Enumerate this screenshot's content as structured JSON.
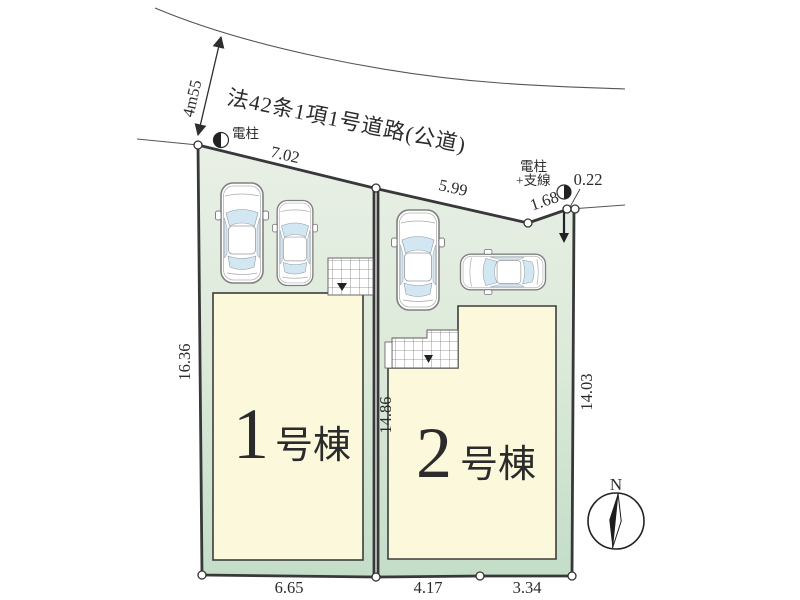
{
  "road": {
    "name": "法42条1項1号道路(公道)",
    "width_label": "4m55"
  },
  "poles": {
    "pole1_label": "電柱",
    "pole2_label_line1": "電柱",
    "pole2_label_line2": "+支線"
  },
  "dimensions": {
    "frontage_1": "7.02",
    "frontage_2": "5.99",
    "frontage_3": "1.68",
    "corner_offset": "0.22",
    "west_side": "16.36",
    "center_boundary": "14.86",
    "east_side": "14.03",
    "south_lot1": "6.65",
    "south_lot2_a": "4.17",
    "south_lot2_b": "3.34"
  },
  "buildings": [
    {
      "number": "1",
      "suffix": "号棟"
    },
    {
      "number": "2",
      "suffix": "号棟"
    }
  ],
  "compass": {
    "north_label": "N"
  },
  "colors": {
    "ground_top": "#e9efe6",
    "ground_mid": "#dcead9",
    "ground_bottom": "#c3ddc8",
    "building_fill": "#fbf8dc",
    "outline": "#383838",
    "glass": "#d3e7f3"
  }
}
